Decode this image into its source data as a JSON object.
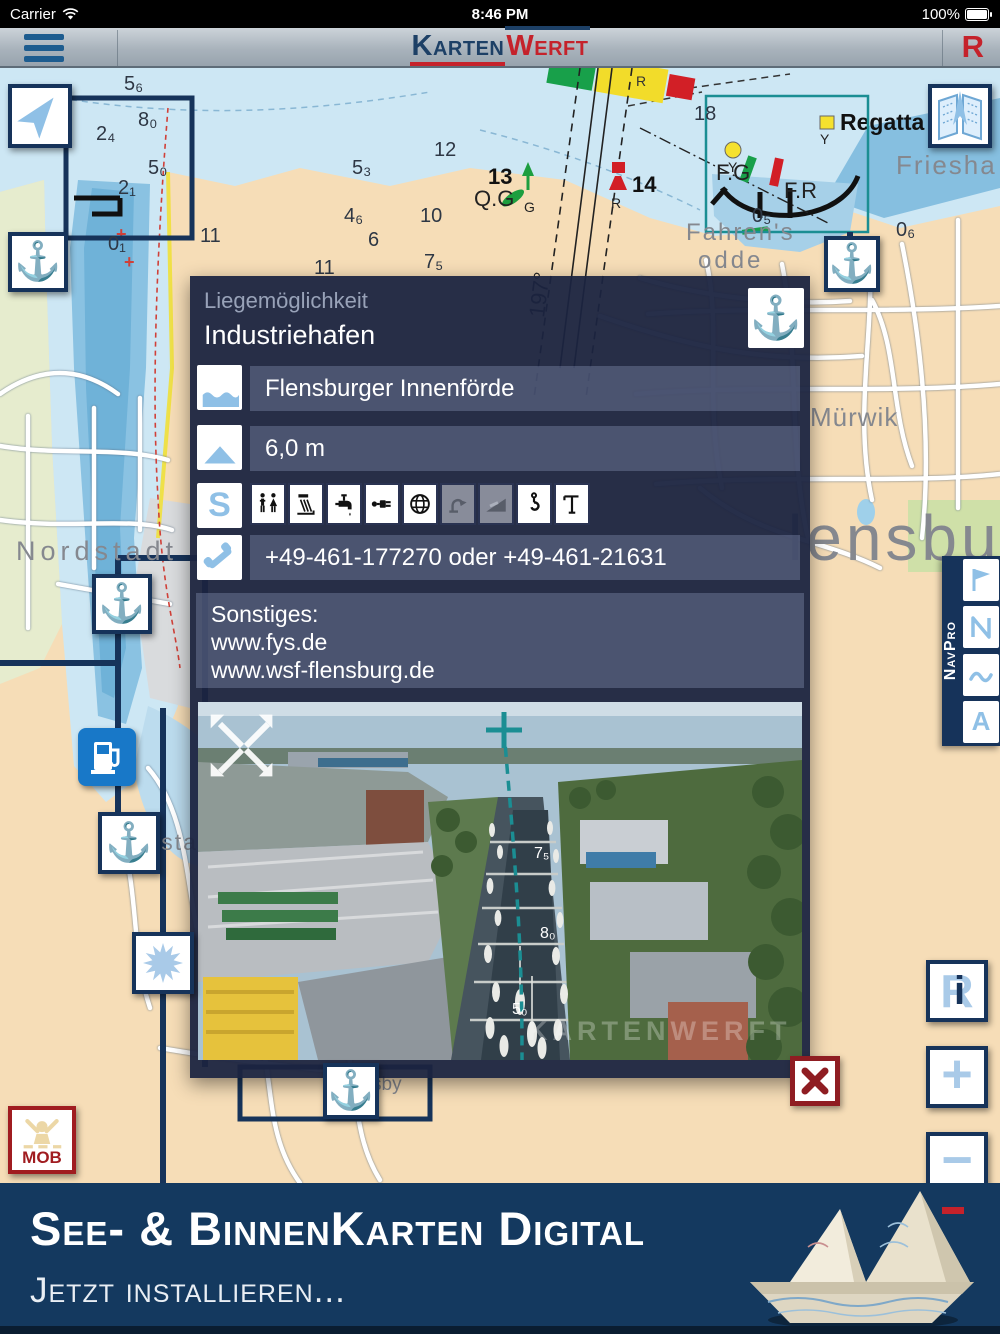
{
  "status_bar": {
    "carrier": "Carrier",
    "time": "8:46 PM",
    "battery_percent": "100%"
  },
  "nav_bar": {
    "logo_primary": "Karten",
    "logo_secondary": "Werft",
    "route_button_label": "R"
  },
  "map": {
    "navpro_label": "NavPro",
    "navpro_a_label": "A",
    "mob_label": "MOB",
    "zoom_in_label": "+",
    "zoom_out_label": "−",
    "info_r_label": "R",
    "info_i_label": "i",
    "labels": {
      "nordstadt": "Nordstadt",
      "neustadt": "Neustadt",
      "fahrens": "Fahren's",
      "odde": "odde",
      "frieshafen": "Friesha",
      "muerwik": "Mürwik",
      "flensburg_partial": "lensbu",
      "sby_partial": "sby",
      "regatta": "Regatta",
      "light_fg": "F.G",
      "light_fr": "F.R",
      "buoy13_no": "13",
      "buoy13_light": "Q.G",
      "buoy13_color": "G",
      "buoy14_no": "14",
      "buoy14_color": "R",
      "buoy_y1": "Y",
      "buoy_y2": "Y",
      "sector_r": "R",
      "bearing": "197°",
      "plus1": "+",
      "plus2": "+"
    },
    "depths": [
      "5₆",
      "8₀",
      "2₄",
      "5₀",
      "2₁",
      "0₁",
      "11",
      "12",
      "11",
      "18",
      "4₆",
      "5₃",
      "6",
      "7₅",
      "10",
      "0₅",
      "0₆"
    ]
  },
  "popup": {
    "type_label": "Liegemöglichkeit",
    "title": "Industriehafen",
    "area_value": "Flensburger Innenförde",
    "depth_value": "6,0 m",
    "services_letter": "S",
    "phone_value": "+49-461-177270 oder +49-461-21631",
    "other_heading": "Sonstiges:",
    "website_1": "www.fys.de",
    "website_2": "www.wsf-flensburg.de",
    "photo_marks": [
      "7₅",
      "8₀",
      "5₀"
    ],
    "photo_watermark": "KARTENWERFT",
    "amenities": [
      {
        "name": "restrooms",
        "enabled": true
      },
      {
        "name": "shower",
        "enabled": true
      },
      {
        "name": "fresh-water",
        "enabled": true
      },
      {
        "name": "shore-power",
        "enabled": true
      },
      {
        "name": "internet",
        "enabled": true
      },
      {
        "name": "pump-out",
        "enabled": false
      },
      {
        "name": "slipway",
        "enabled": false
      },
      {
        "name": "crane",
        "enabled": true
      },
      {
        "name": "mast-crane",
        "enabled": true
      }
    ]
  },
  "banner": {
    "title": "See- & BinnenKarten Digital",
    "subtitle": "Jetzt installieren..."
  },
  "colors": {
    "accent_blue": "#8fc0e6",
    "navy": "#16335a",
    "brand_red": "#c5222b",
    "teal": "#1b8e93",
    "popup_bg": "#1b2440",
    "banner_bg": "#14395f"
  }
}
